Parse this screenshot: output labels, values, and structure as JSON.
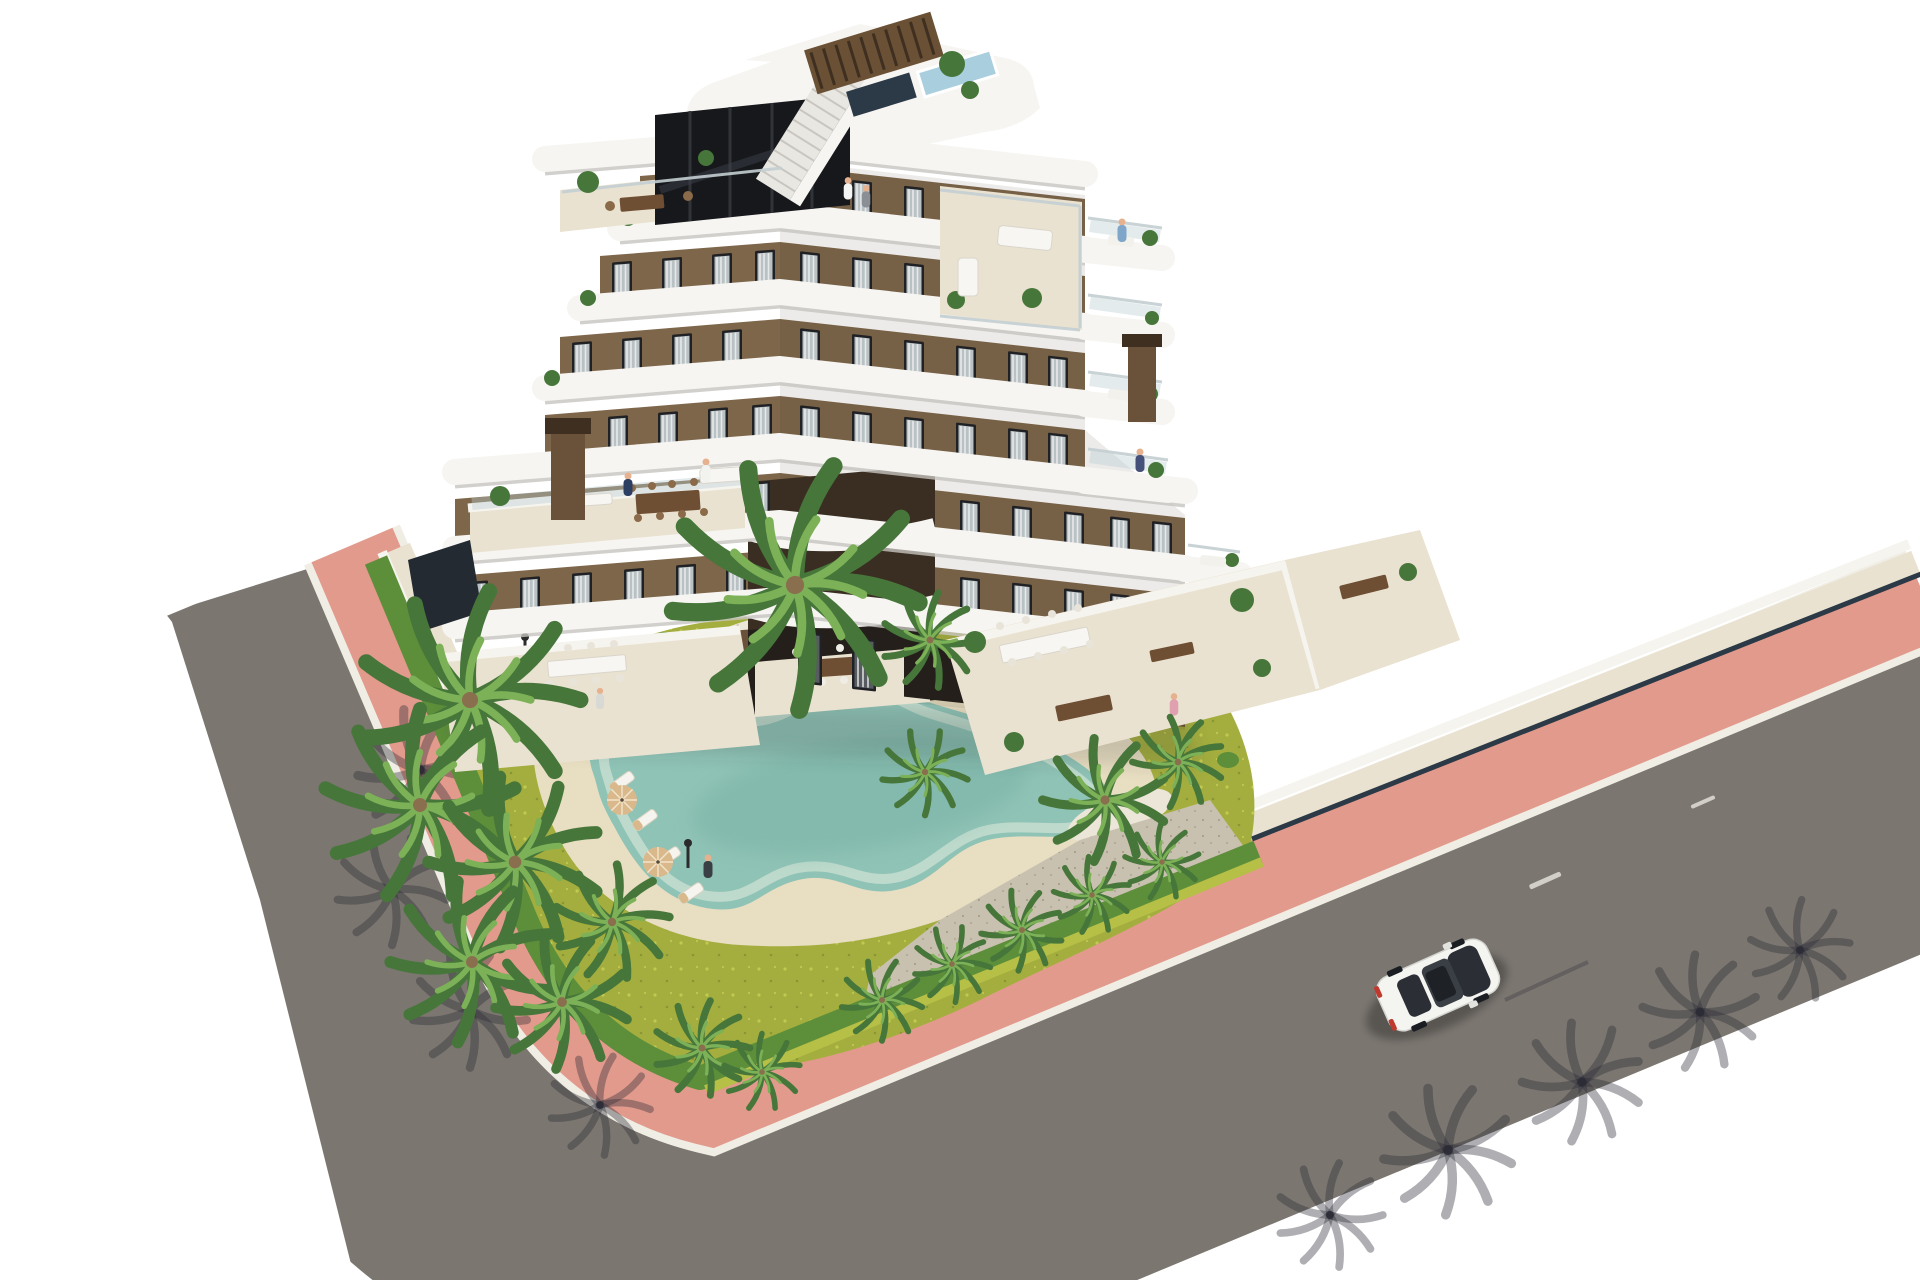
{
  "meta": {
    "title": "Aerial 3D render of a modern apartment complex",
    "description": "Bird's-eye architectural visualization of a stepped six-storey apartment building with white curved balcony bands and brown facade, rooftop solarium terraces with pergola and stair access, landscaped corner plot with lawn, palm trees, trimmed hedges, a freeform sandy-edged swimming pool with sun loungers and parasols, salmon-pink paved sidewalks wrapping the corner, gray asphalt roads and a single white car driving on the right-hand road."
  },
  "scene": {
    "building_storeys": 6,
    "car_count": 1,
    "pool_count": 1,
    "umbrella_count": 3,
    "objects": [
      {
        "name": "apartment-building",
        "label": "stepped white and brown apartment block"
      },
      {
        "name": "rooftop-terrace",
        "label": "rooftop solarium with pergola and stairs"
      },
      {
        "name": "swimming-pool",
        "label": "freeform lagoon pool with sand beach"
      },
      {
        "name": "garden",
        "label": "lawn with palm trees, hedges and gravel beds"
      },
      {
        "name": "roads",
        "label": "asphalt roads with pink paved sidewalk"
      },
      {
        "name": "car",
        "label": "white car on the road"
      }
    ]
  },
  "palette": {
    "bg": "#ffffff",
    "facade": "#7d664a",
    "facadeDark": "#6a5139",
    "facadeDeep": "#3a2e22",
    "slab": "#f6f5f2",
    "slabEdge": "#c7c4bf",
    "terrace": "#eae2d0",
    "terraceShade": "#d9cfb8",
    "frame": "#202124",
    "glass": "#b9c1c4",
    "glassDark": "#565c60",
    "curtain": "#eef0f0",
    "doorway": "#241f1b",
    "pergola": "#6a5034",
    "pergolaDark": "#3e2f21",
    "navyGlass": "#2c3947",
    "roofPool": "#a9cede",
    "stair": "#e9e7e2",
    "grass": "#a4ae3f",
    "grassLight": "#c2c94f",
    "hedge": "#5d8f3a",
    "hedgeYellow": "#b6bf46",
    "palmDark": "#47763a",
    "palmLight": "#7cb157",
    "trunk": "#8a6f4e",
    "sand": "#e8dec2",
    "pebble": "#ece6d8",
    "gravel": "#c9c1b0",
    "water": "#8fc3b6",
    "waterEdge": "#c5ded0",
    "waterDeep": "#7ab3a6",
    "road": "#7b7670",
    "pink": "#e29a8c",
    "pinkLight": "#ecb3a6",
    "curb": "#efede4",
    "wall": "#f6f4ee",
    "shadow": "rgba(50,46,40,0.30)",
    "carBody": "#f4f4f1",
    "carGlass": "#2b2f35",
    "tail": "#c0392f",
    "skin": "#e6b18e",
    "navy": "#2c3e62",
    "tan": "#d9b98c",
    "woodTable": "#6e4f33"
  }
}
